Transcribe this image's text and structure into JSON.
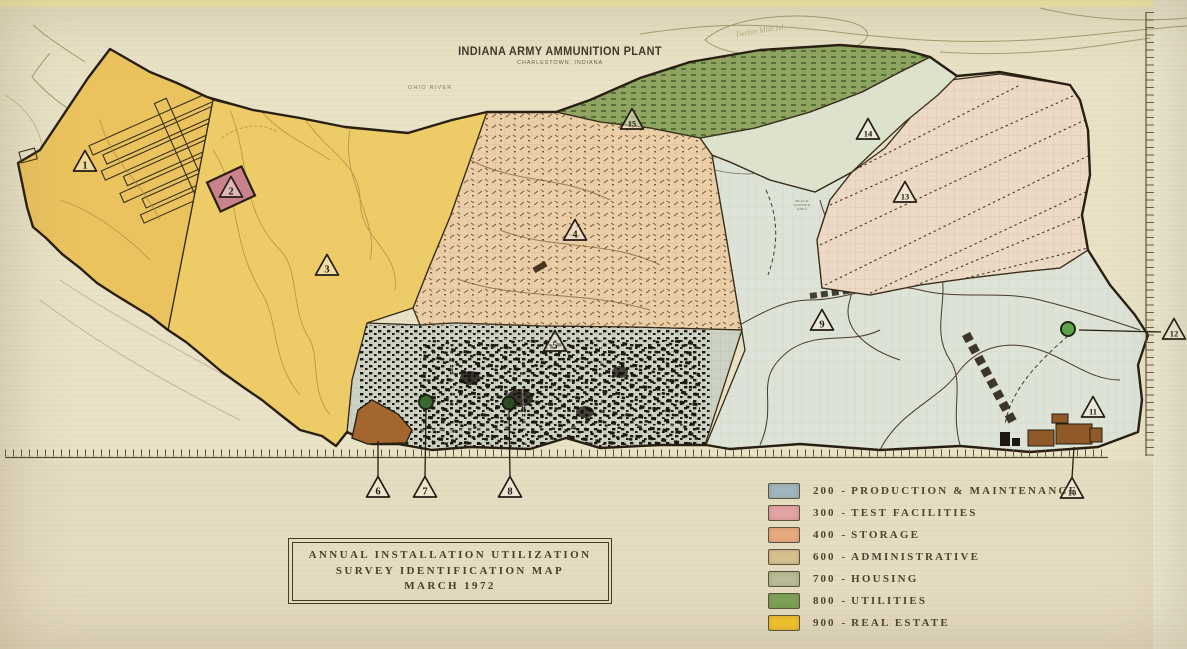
{
  "photo": {
    "background": "#e9e2c6",
    "top_strip_color": "#f3eeae",
    "lower_area_color": "#e6dcc1",
    "right_margin_color": "#ede8d1"
  },
  "header": {
    "title": "INDIANA ARMY AMMUNITION PLANT",
    "subtitle": "CHARLESTOWN, INDIANA"
  },
  "map_labels": {
    "river": "OHIO RIVER",
    "island": "Twelve Mile Isl.",
    "area": "BLACK POWDER AREA"
  },
  "title_box": {
    "lines": [
      "ANNUAL INSTALLATION UTILIZATION",
      "SURVEY IDENTIFICATION MAP",
      "MARCH 1972"
    ]
  },
  "legend": {
    "separator": "-",
    "items": [
      {
        "code": "200",
        "name": "PRODUCTION & MAINTENANCE",
        "color": "#9fb6bd"
      },
      {
        "code": "300",
        "name": "TEST FACILITIES",
        "color": "#e2a3a4"
      },
      {
        "code": "400",
        "name": "STORAGE",
        "color": "#e9a97e"
      },
      {
        "code": "600",
        "name": "ADMINISTRATIVE",
        "color": "#d6c08f"
      },
      {
        "code": "700",
        "name": "HOUSING",
        "color": "#b9bc96"
      },
      {
        "code": "800",
        "name": "UTILITIES",
        "color": "#7ca355"
      },
      {
        "code": "900",
        "name": "REAL ESTATE",
        "color": "#f3c62d"
      }
    ]
  },
  "markers": [
    {
      "label": "1",
      "x": 85,
      "y": 163
    },
    {
      "label": "2",
      "x": 231,
      "y": 189
    },
    {
      "label": "3",
      "x": 327,
      "y": 267
    },
    {
      "label": "4",
      "x": 575,
      "y": 232
    },
    {
      "label": "5",
      "x": 555,
      "y": 343
    },
    {
      "label": "6",
      "x": 378,
      "y": 489,
      "leader": {
        "x": 378,
        "y": 441
      }
    },
    {
      "label": "7",
      "x": 425,
      "y": 489,
      "leader": {
        "x": 426,
        "y": 409
      }
    },
    {
      "label": "8",
      "x": 510,
      "y": 489,
      "leader": {
        "x": 509,
        "y": 411
      }
    },
    {
      "label": "9",
      "x": 822,
      "y": 322
    },
    {
      "label": "10",
      "x": 1072,
      "y": 490,
      "leader": {
        "x": 1074,
        "y": 447
      }
    },
    {
      "label": "11",
      "x": 1093,
      "y": 409
    },
    {
      "label": "12",
      "x": 1174,
      "y": 331,
      "leader": {
        "x": 1079,
        "y": 330
      }
    },
    {
      "label": "13",
      "x": 905,
      "y": 194
    },
    {
      "label": "14",
      "x": 868,
      "y": 131
    },
    {
      "label": "15",
      "x": 632,
      "y": 121
    }
  ],
  "map": {
    "zone_colors": {
      "zone1": "#eac35f",
      "zone3": "#edcb67",
      "zone4": "#ebcfa8",
      "zone5": "#ccd3c5",
      "zone9": "#dde3d7",
      "zone13": "#ecd9c6",
      "zone14": "#dde2cd",
      "zone15": "#90a562",
      "brown_patch": "#a3672e",
      "se_buildings": "#8f5a28",
      "test_site_box": "#c9818c",
      "boundary": "#281f12",
      "water": "#9b9166"
    },
    "symbols": {
      "green_circle_1": "#3a6a31",
      "green_circle_2": "#2c4a23",
      "green_circle_3": "#5ea34c"
    }
  }
}
